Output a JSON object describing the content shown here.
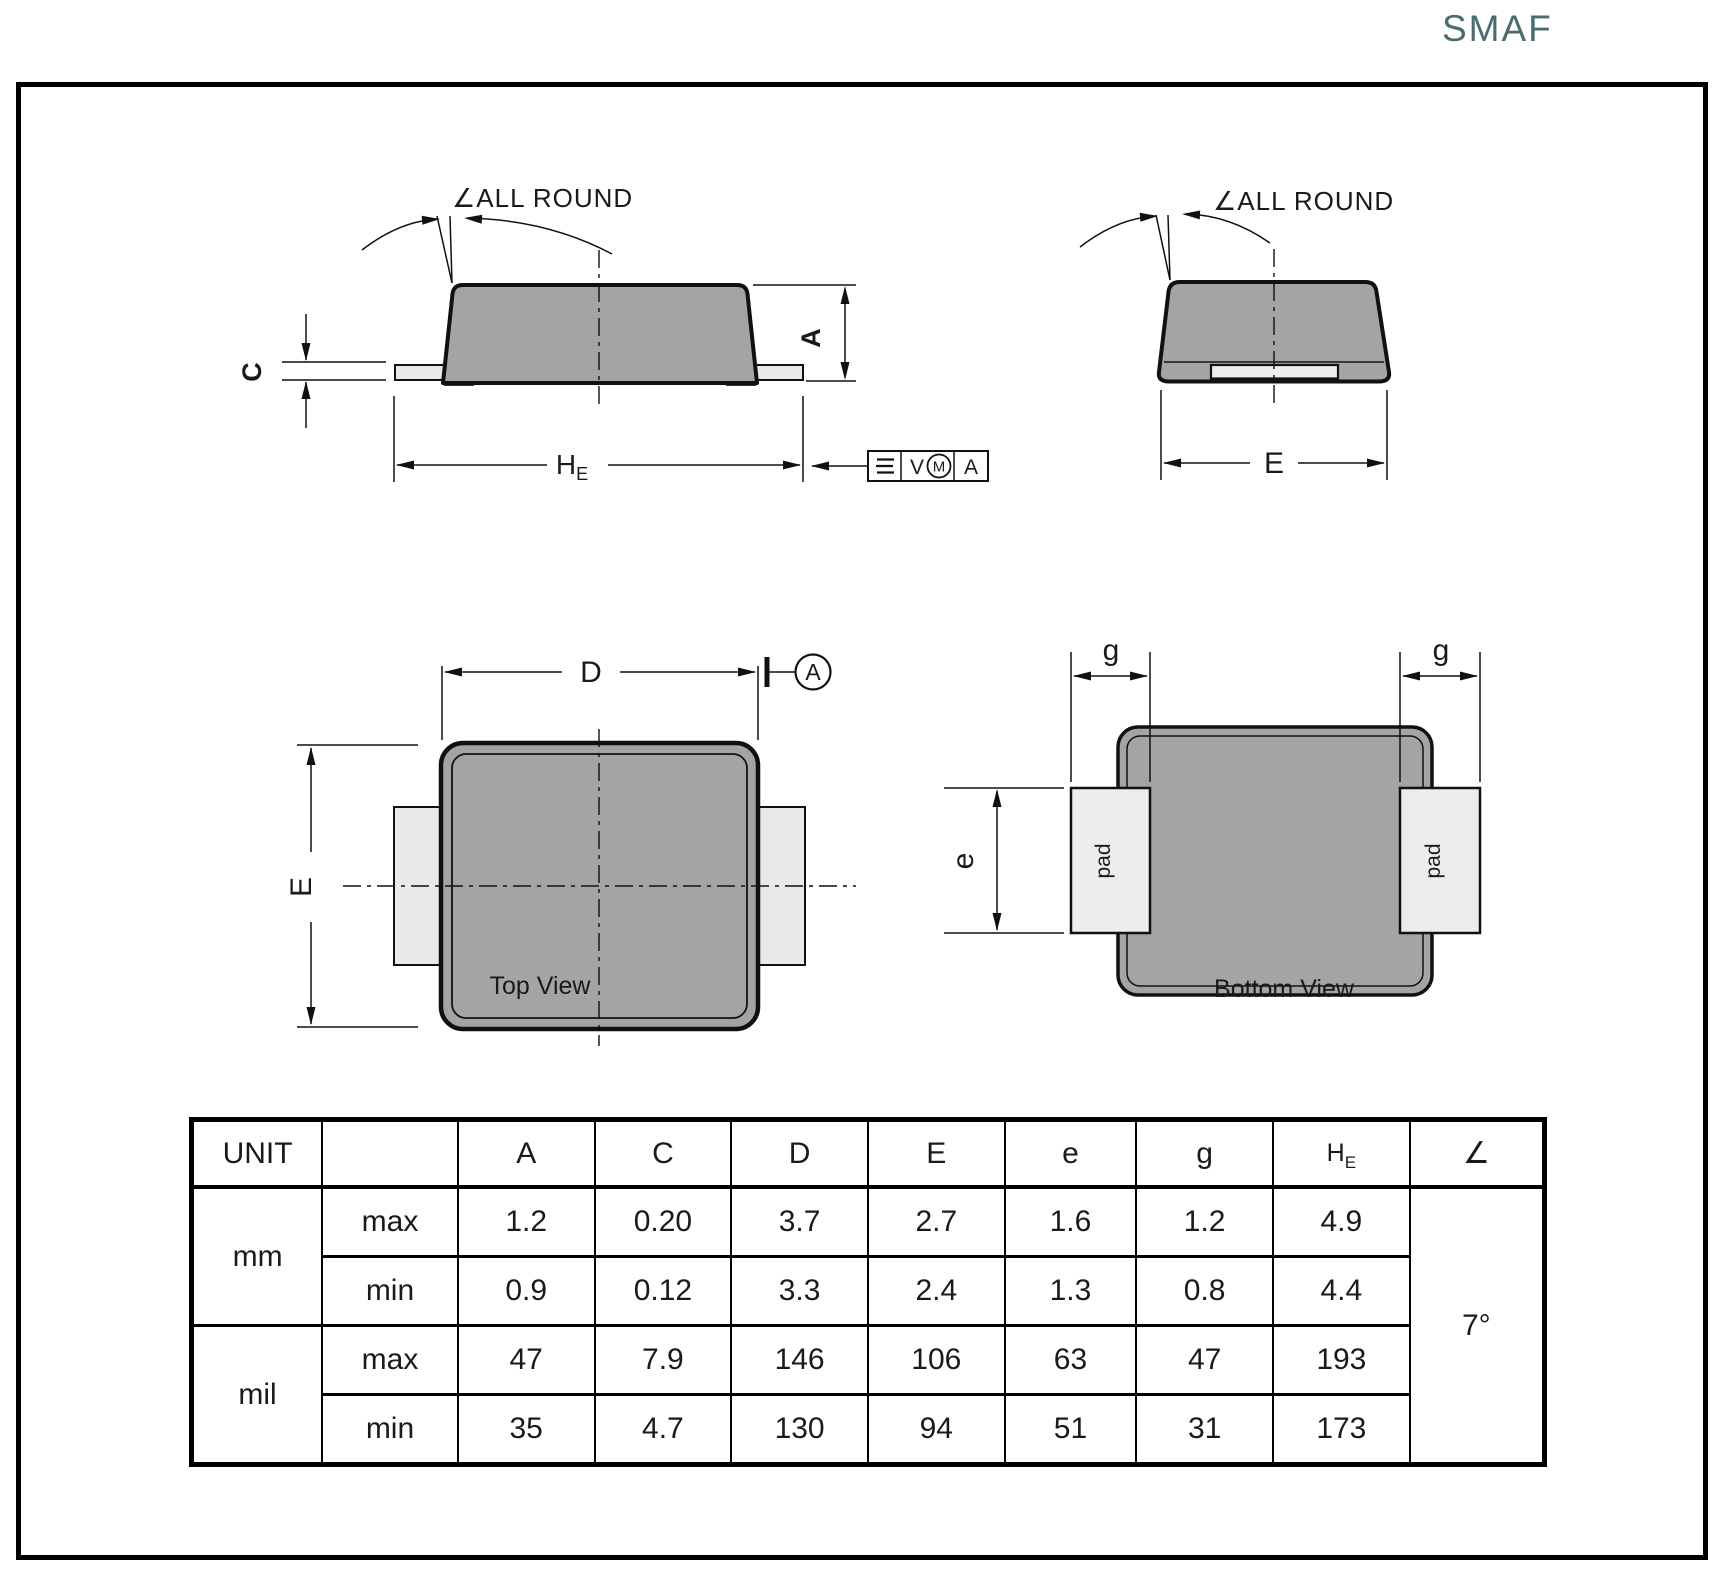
{
  "title": "SMAF",
  "colors": {
    "title_accent": "#4B6C6E",
    "body_fill": "#A4A4A4",
    "pad_fill": "#E9E9E9",
    "line": "#111111"
  },
  "front_view": {
    "all_round_label": "∠ALL ROUND",
    "dim_c": "C",
    "dim_a": "A",
    "he_main": "H",
    "he_sub": "E",
    "fcf": {
      "tolerance": "V",
      "modifier": "M",
      "datum": "A"
    }
  },
  "end_view": {
    "all_round_label": "∠ALL ROUND",
    "dim_e": "E"
  },
  "top_view": {
    "dim_d": "D",
    "datum": "A",
    "dim_e": "E",
    "caption": "Top View"
  },
  "bottom_view": {
    "dim_g_left": "g",
    "dim_g_right": "g",
    "dim_e": "e",
    "pad_left": "pad",
    "pad_right": "pad",
    "caption": "Bottom  View"
  },
  "table": {
    "unit_header": "UNIT",
    "col_headers": [
      "A",
      "C",
      "D",
      "E",
      "e",
      "g"
    ],
    "he_header": {
      "main": "H",
      "sub": "E"
    },
    "angle_header": "∠",
    "angle_value": "7°",
    "rows": [
      {
        "unit": "mm",
        "label": "max",
        "values": [
          "1.2",
          "0.20",
          "3.7",
          "2.7",
          "1.6",
          "1.2",
          "4.9"
        ]
      },
      {
        "unit": "",
        "label": "min",
        "values": [
          "0.9",
          "0.12",
          "3.3",
          "2.4",
          "1.3",
          "0.8",
          "4.4"
        ]
      },
      {
        "unit": "mil",
        "label": "max",
        "values": [
          "47",
          "7.9",
          "146",
          "106",
          "63",
          "47",
          "193"
        ]
      },
      {
        "unit": "",
        "label": "min",
        "values": [
          "35",
          "4.7",
          "130",
          "94",
          "51",
          "31",
          "173"
        ]
      }
    ]
  }
}
